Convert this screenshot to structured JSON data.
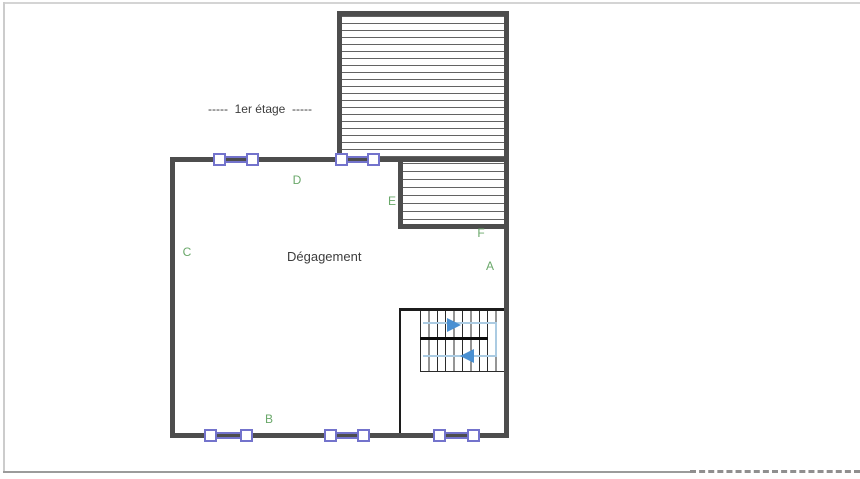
{
  "floor_plan": {
    "stage_label": "-----  1er étage  -----",
    "room_label": "Dégagement",
    "wall_labels": {
      "a": "A",
      "b": "B",
      "c": "C",
      "d": "D",
      "e": "E",
      "f": "F"
    },
    "colors": {
      "wall_grey": "#4d4d4d",
      "window_frame_purple": "#7373cc",
      "label_green": "#6aa86a",
      "text_dark": "#3d3d3d",
      "stair_arrow_blue": "#4a90d2",
      "stair_path_blue": "#abcbe2"
    }
  }
}
